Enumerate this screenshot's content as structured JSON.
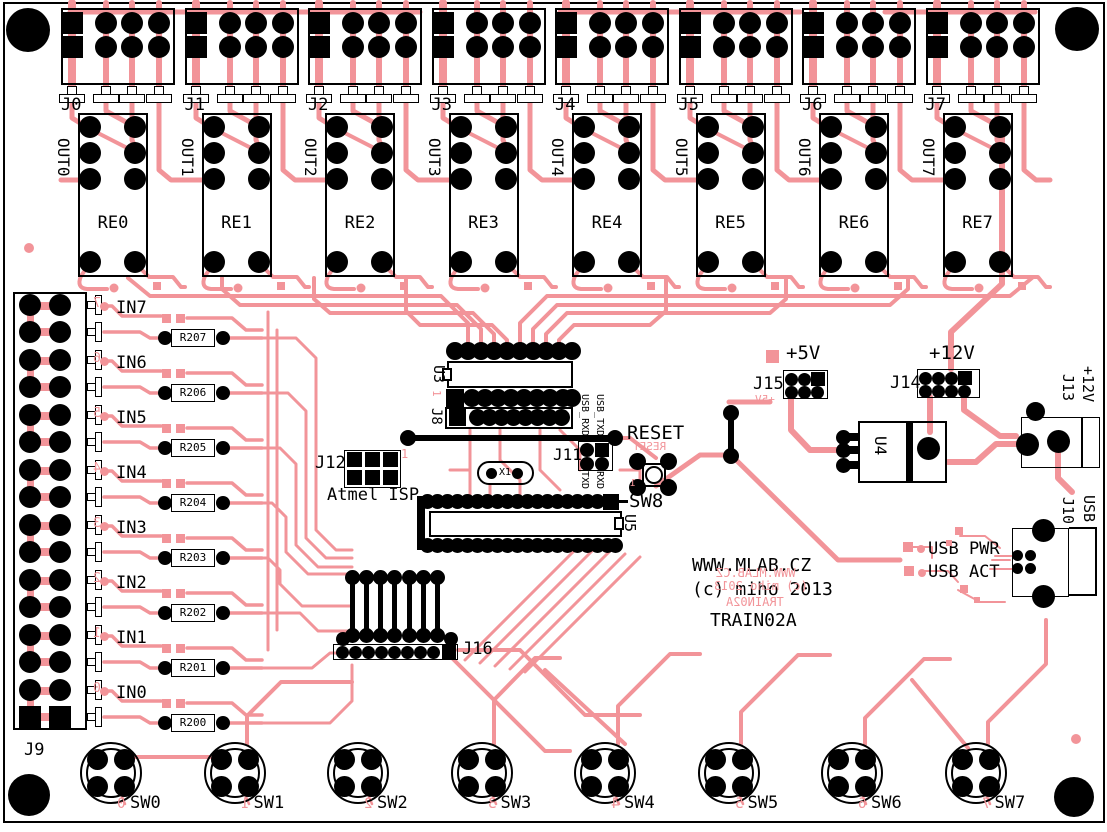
{
  "colors": {
    "copper": "#f29499",
    "silkscreen": "#000000",
    "board": "#ffffff"
  },
  "title_block": {
    "line1": "WWW.MLAB.CZ",
    "line2": "(c) miho 2013",
    "line3": "TRAIN02A",
    "mirror1": "WWW.MLAB.CZ",
    "mirror2": "(c) miho 2013",
    "mirror3": "TRAIN02A"
  },
  "outputs": [
    {
      "connector": "J0",
      "out": "OUT0",
      "relay": "RE0"
    },
    {
      "connector": "J1",
      "out": "OUT1",
      "relay": "RE1"
    },
    {
      "connector": "J2",
      "out": "OUT2",
      "relay": "RE2"
    },
    {
      "connector": "J3",
      "out": "OUT3",
      "relay": "RE3"
    },
    {
      "connector": "J4",
      "out": "OUT4",
      "relay": "RE4"
    },
    {
      "connector": "J5",
      "out": "OUT5",
      "relay": "RE5"
    },
    {
      "connector": "J6",
      "out": "OUT6",
      "relay": "RE6"
    },
    {
      "connector": "J7",
      "out": "OUT7",
      "relay": "RE7"
    }
  ],
  "inputs": [
    {
      "label": "IN0",
      "resistor": "R200",
      "mirror_digit": "0"
    },
    {
      "label": "IN1",
      "resistor": "R201",
      "mirror_digit": "1"
    },
    {
      "label": "IN2",
      "resistor": "R202",
      "mirror_digit": "2"
    },
    {
      "label": "IN3",
      "resistor": "R203",
      "mirror_digit": "3"
    },
    {
      "label": "IN4",
      "resistor": "R204",
      "mirror_digit": "4"
    },
    {
      "label": "IN5",
      "resistor": "R205",
      "mirror_digit": "5"
    },
    {
      "label": "IN6",
      "resistor": "R206",
      "mirror_digit": "6"
    },
    {
      "label": "IN7",
      "resistor": "R207",
      "mirror_digit": "7"
    }
  ],
  "switches": [
    {
      "label": "SW0",
      "mirror_digit": "0"
    },
    {
      "label": "SW1",
      "mirror_digit": "1"
    },
    {
      "label": "SW2",
      "mirror_digit": "2"
    },
    {
      "label": "SW3",
      "mirror_digit": "3"
    },
    {
      "label": "SW4",
      "mirror_digit": "4"
    },
    {
      "label": "SW5",
      "mirror_digit": "5"
    },
    {
      "label": "SW6",
      "mirror_digit": "6"
    },
    {
      "label": "SW7",
      "mirror_digit": "7"
    }
  ],
  "left": {
    "j9": "J9"
  },
  "center": {
    "u3": "U3",
    "u3_pin1": "1",
    "j8": "J8",
    "j12": "J12",
    "j12_desc": "Atmel ISP",
    "j12_pin1": "1",
    "x1": "X1",
    "j11": "J11",
    "j11_top": [
      "USB_RXD",
      "USB_TXD"
    ],
    "j11_bottom": [
      "TXD",
      "RXD"
    ],
    "reset": "RESET",
    "reset_mirror": "RESET",
    "sw8_pin1": "1",
    "sw8": "SW8",
    "u5": "U5",
    "j16": "J16"
  },
  "power": {
    "j15": "J15",
    "v5": "+5V",
    "v5_mirror": "+5V",
    "j14": "J14",
    "v12": "+12V",
    "u4": "U4",
    "j13": "J13",
    "j13_v": "+12V",
    "j10": "J10",
    "j10_usb": "USB",
    "usb_pwr": "USB PWR",
    "usb_act": "USB ACT"
  }
}
